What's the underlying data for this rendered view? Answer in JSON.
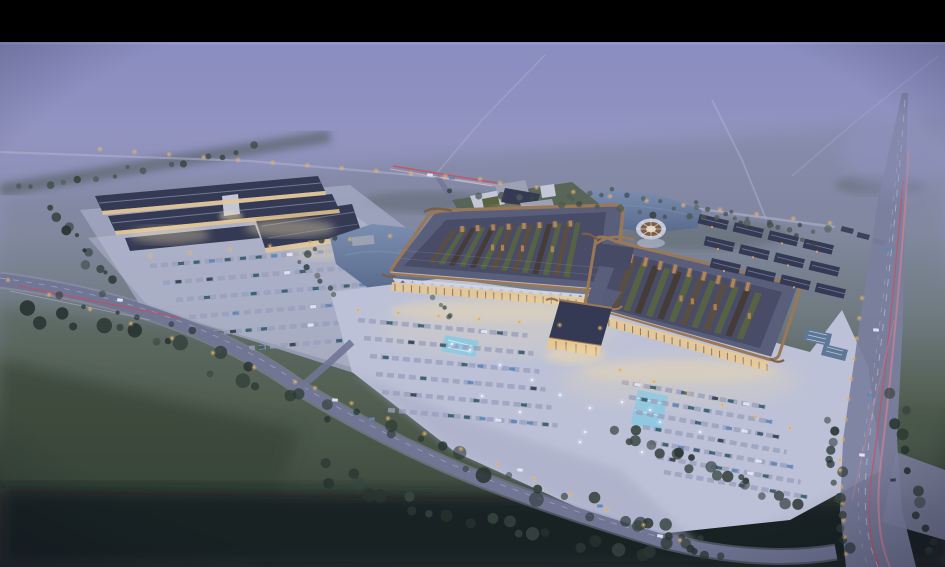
{
  "frame": {
    "bar": "#000000"
  },
  "palette": {
    "bar": "#000000",
    "skyTop": "#7d81ba",
    "skyMid": "#9294c0",
    "skyLow": "#8a90ad",
    "hazeGreen": "#6e7a7e",
    "fieldGreen": "#4f5d4c",
    "fieldDark": "#31402f",
    "groundDark": "#1b231e",
    "bottomDark": "#0e1417",
    "treeDark": "#233029",
    "treeMid": "#33423a",
    "treeLight": "#4a594b",
    "treeHaze": "#46544e",
    "roadFaint": "#b2b5d2",
    "roadMain": "#6f7592",
    "roadEdge": "#9ba0bb",
    "highway": "#7b7f9d",
    "laneLine": "#c9ccdf",
    "plaza": "#c0c5d9",
    "plazaShade": "#a6abc4",
    "stall": "#9ba1bd",
    "roofDark": "#30364e",
    "roofMid": "#575c78",
    "roofBand": "#42475f",
    "ridge": "#8e93ad",
    "bronze": "#9c764f",
    "bronzeDark": "#7c5c3d",
    "eaveWhite": "#dcdfe9",
    "courtGreen": "#55613a",
    "courtBrown": "#41382c",
    "lattice": "#5a4c3a",
    "skylight": "#c08a50",
    "glassWarm": "#eecb8d",
    "glowWarm": "#f6e0ac",
    "facadePier": "#6e7288",
    "canopy": "#d4d9e7",
    "annexWhite": "#c6cad8",
    "annexGrey": "#9fa3b4",
    "lawn": "#54614d",
    "water": "#56688a",
    "waterLight": "#7a8fb0",
    "poolCyan": "#7fd0e8",
    "lamp": "#ecab52",
    "lampGlow": "#f7c877",
    "tailRed": "#d6494f",
    "streakPink": "#e2808f",
    "carWhite": "#e8eefc",
    "carBlue": "#5b87b8",
    "carTeal": "#2f5a66",
    "carDark": "#2e3a46",
    "paneBlue": "#5d7694"
  }
}
